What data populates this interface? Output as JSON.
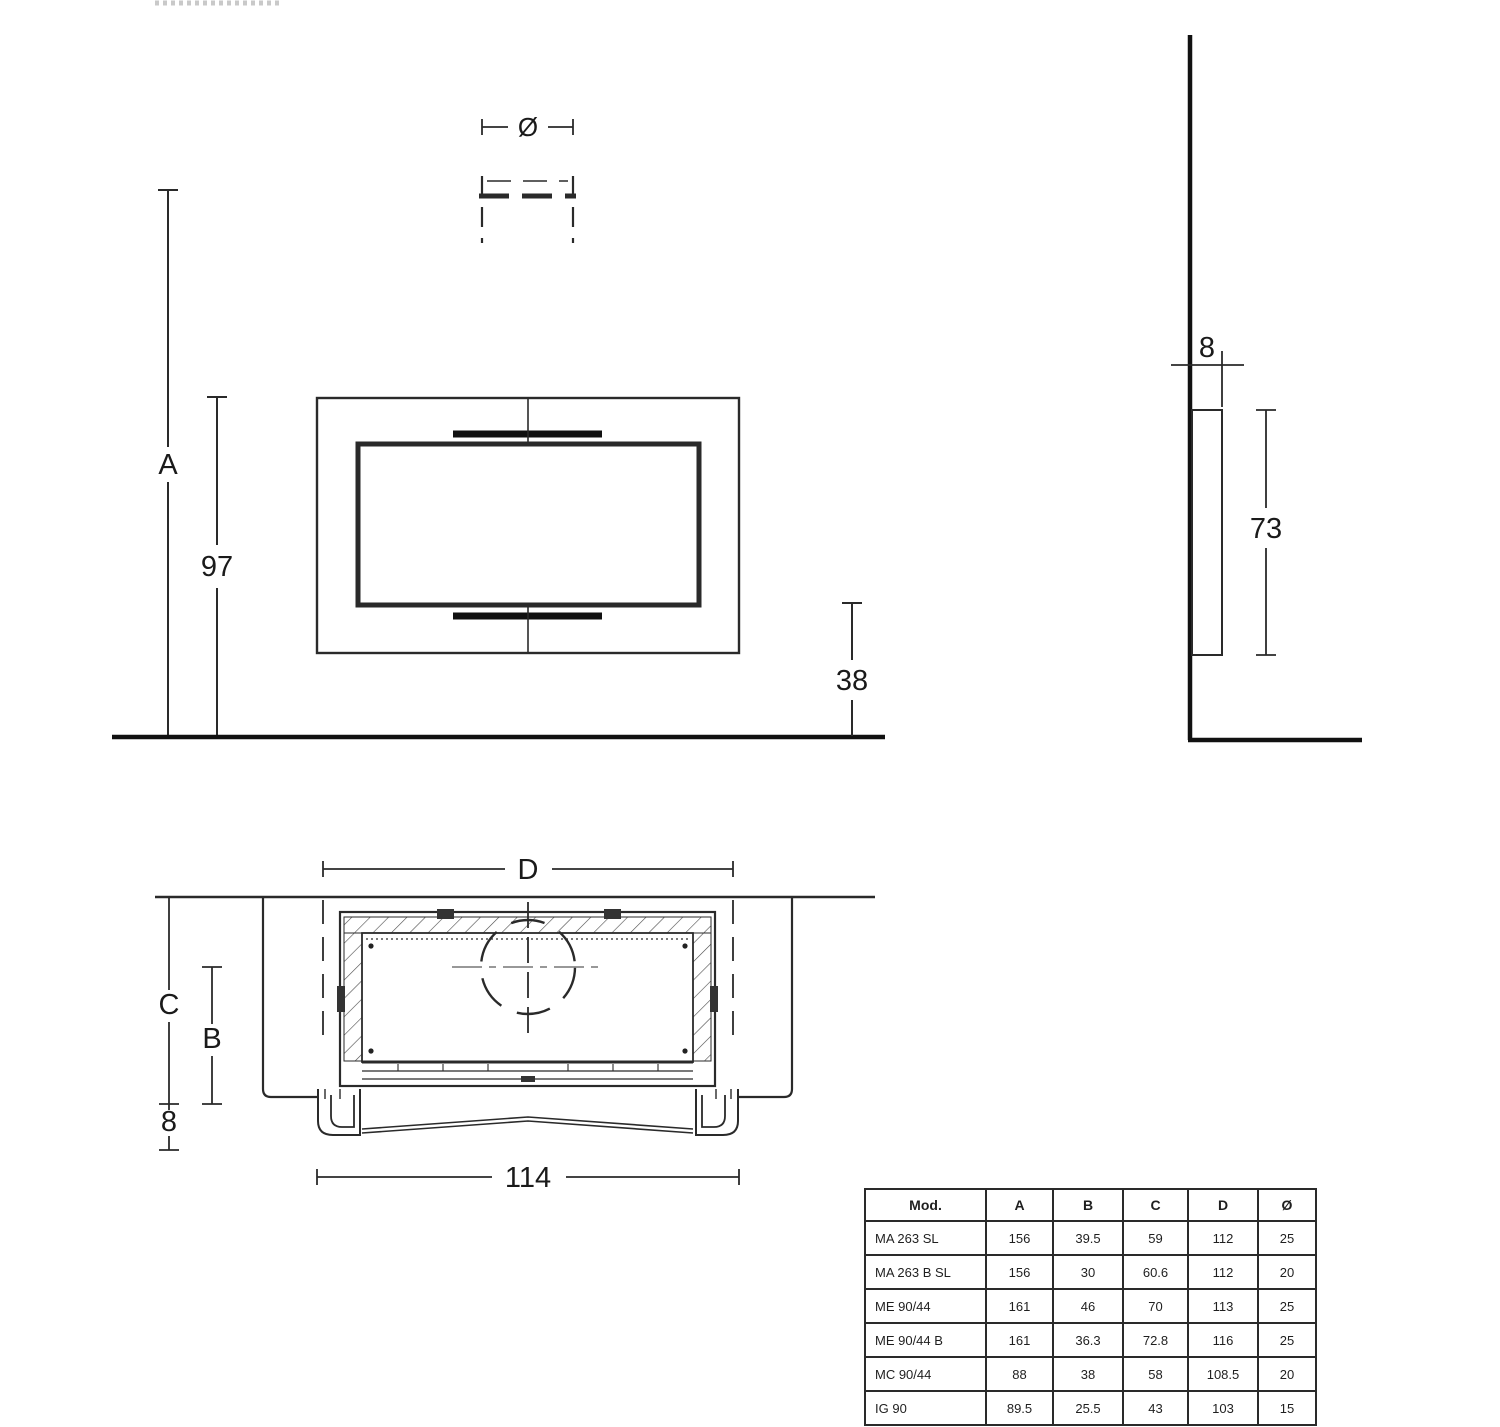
{
  "dims": {
    "front": {
      "overall_height": "A",
      "hearth_height": "97",
      "floor_clearance": "38",
      "flue_diameter": "Ø"
    },
    "side": {
      "depth": "8",
      "unit_height": "73"
    },
    "plan": {
      "niche_width": "D",
      "depth_c": "C",
      "depth_b": "B",
      "protrusion": "8",
      "unit_width": "114"
    }
  },
  "table": {
    "headers": [
      "Mod.",
      "A",
      "B",
      "C",
      "D",
      "Ø"
    ],
    "rows": [
      [
        "MA 263 SL",
        "156",
        "39.5",
        "59",
        "112",
        "25"
      ],
      [
        "MA 263 B SL",
        "156",
        "30",
        "60.6",
        "112",
        "20"
      ],
      [
        "ME 90/44",
        "161",
        "46",
        "70",
        "113",
        "25"
      ],
      [
        "ME 90/44 B",
        "161",
        "36.3",
        "72.8",
        "116",
        "25"
      ],
      [
        "MC 90/44",
        "88",
        "38",
        "58",
        "108.5",
        "20"
      ],
      [
        "IG 90",
        "89.5",
        "25.5",
        "43",
        "103",
        "15"
      ]
    ]
  },
  "colors": {
    "line": "#2a2a2a",
    "heavy_line": "#111111",
    "centerline_gray": "#8a8a8a",
    "background": "#ffffff"
  }
}
